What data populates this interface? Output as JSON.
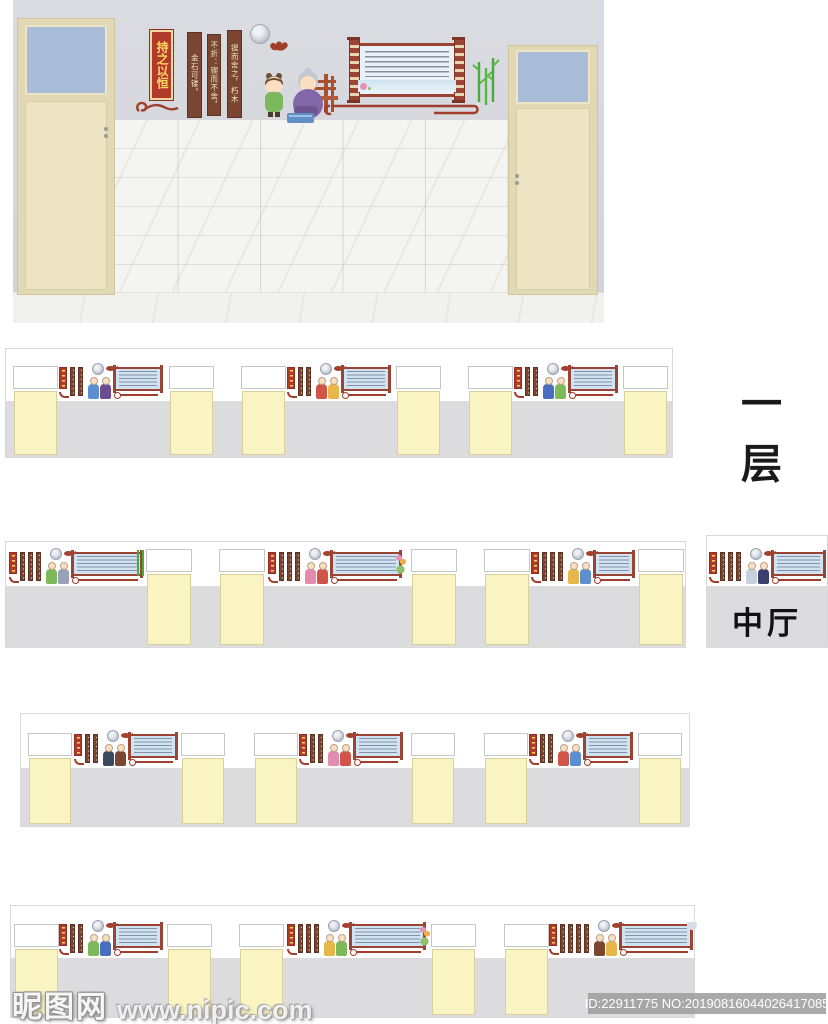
{
  "render": {
    "plaque_text": "持之以恒",
    "wood_strips": [
      "金石可镂。",
      "不折：锲而不舍，",
      "锲而舍之，朽木"
    ]
  },
  "labels": {
    "floor1": "一层",
    "hall": "中厅"
  },
  "watermark": {
    "site": "昵图网",
    "url": "www.nipic.com",
    "id_line": "ID:22911775 NO:20190816044026417085"
  },
  "colors": {
    "maroon_accent": "#a03d2c",
    "plaque_red": "#b23a2c",
    "plaque_text_yellow": "#ffd95e",
    "wood_brown": "#7a4631",
    "door_yellow": "#faf4c2",
    "wainscot_gray": "#dcdcdf",
    "transom_blue": "#a9bcd8",
    "bamboo_green": "#4aa83c",
    "banner_blue": "#dce9f4"
  },
  "rows": [
    {
      "name": "floor1",
      "x": 5,
      "y": 348,
      "w": 668,
      "h": 110,
      "white_h": 52,
      "door_top": 17,
      "door_w": 45,
      "doors": [
        7,
        163,
        235,
        390,
        462,
        617
      ],
      "clusters": [
        {
          "x": 53,
          "strips": 2,
          "figs": [
            "#5b8fd0",
            "#6e4a8e"
          ]
        },
        {
          "x": 281,
          "strips": 2,
          "figs": [
            "#d05548",
            "#e8b74a"
          ]
        },
        {
          "x": 508,
          "strips": 2,
          "figs": [
            "#4a6fc0",
            "#7fba5a"
          ]
        }
      ]
    },
    {
      "name": "hall-main",
      "x": 5,
      "y": 541,
      "w": 681,
      "h": 107,
      "white_h": 44,
      "door_top": 7,
      "door_w": 46,
      "doors": [
        140,
        213,
        405,
        478,
        632
      ],
      "clusters": [
        {
          "x": 3,
          "w": 135,
          "strips": 3,
          "figs": [
            "#7fba5a",
            "#9aa0b8"
          ],
          "extra": "bamboo"
        },
        {
          "x": 262,
          "w": 135,
          "strips": 3,
          "figs": [
            "#e58bb0",
            "#d05548"
          ],
          "extra": "flower"
        },
        {
          "x": 525,
          "strips": 3,
          "figs": [
            "#e8b74a",
            "#5b8fd0"
          ]
        }
      ]
    },
    {
      "name": "hall-panel",
      "x": 706,
      "y": 535,
      "w": 122,
      "h": 113,
      "white_h": 50,
      "door_top": 0,
      "door_w": 0,
      "doors": [],
      "label": "中厅",
      "clusters": [
        {
          "x": 2,
          "w": 118,
          "strips": 3,
          "figs": [
            "#c8d0dc",
            "#3a3f6e"
          ]
        }
      ]
    },
    {
      "name": "floor3",
      "x": 20,
      "y": 713,
      "w": 670,
      "h": 114,
      "white_h": 54,
      "door_top": 19,
      "door_w": 44,
      "doors": [
        7,
        160,
        233,
        390,
        463,
        617
      ],
      "clusters": [
        {
          "x": 53,
          "strips": 2,
          "figs": [
            "#3a4a5e",
            "#7a4631"
          ]
        },
        {
          "x": 278,
          "strips": 2,
          "figs": [
            "#e58bb0",
            "#d05548"
          ]
        },
        {
          "x": 508,
          "strips": 2,
          "figs": [
            "#d05548",
            "#5b8fd0"
          ]
        }
      ]
    },
    {
      "name": "floor4",
      "x": 10,
      "y": 905,
      "w": 685,
      "h": 113,
      "white_h": 52,
      "door_top": 18,
      "door_w": 45,
      "doors": [
        3,
        156,
        228,
        420,
        493
      ],
      "clusters": [
        {
          "x": 48,
          "strips": 2,
          "figs": [
            "#7fba5a",
            "#4a6fc0"
          ]
        },
        {
          "x": 276,
          "w": 140,
          "strips": 3,
          "figs": [
            "#e8b74a",
            "#7fba5a"
          ],
          "extra": "flower"
        },
        {
          "x": 538,
          "w": 145,
          "strips": 4,
          "figs": [
            "#7a4631",
            "#e8b74a"
          ],
          "extra": "fan"
        }
      ]
    }
  ]
}
